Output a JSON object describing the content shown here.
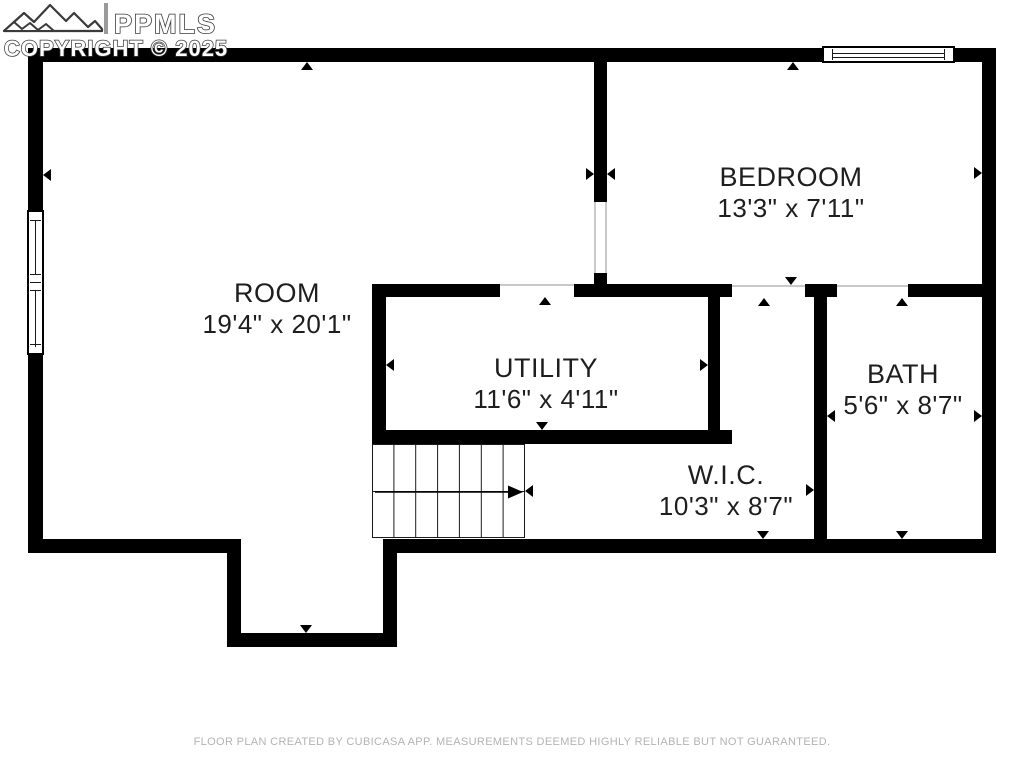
{
  "watermark": {
    "brand": "PPMLS",
    "copyright": "COPYRIGHT © 2025",
    "logo_icon": "mountain-peaks-icon"
  },
  "rooms": {
    "room": {
      "label": "ROOM",
      "dimensions": "19'4\" x 20'1\""
    },
    "bedroom": {
      "label": "BEDROOM",
      "dimensions": "13'3\" x 7'11\""
    },
    "utility": {
      "label": "UTILITY",
      "dimensions": "11'6\" x 4'11\""
    },
    "wic": {
      "label": "W.I.C.",
      "dimensions": "10'3\" x 8'7\""
    },
    "bath": {
      "label": "BATH",
      "dimensions": "5'6\" x 8'7\""
    }
  },
  "stairs": {
    "steps": 7,
    "direction_icon": "stairs-up-arrow-icon"
  },
  "footer": {
    "disclaimer": "FLOOR PLAN CREATED BY CUBICASA APP. MEASUREMENTS DEEMED HIGHLY RELIABLE BUT NOT GUARANTEED."
  },
  "colors": {
    "wall": "#000000",
    "label_text": "#1e1e1e",
    "footer_text": "#b3b3b3",
    "background": "#ffffff"
  }
}
